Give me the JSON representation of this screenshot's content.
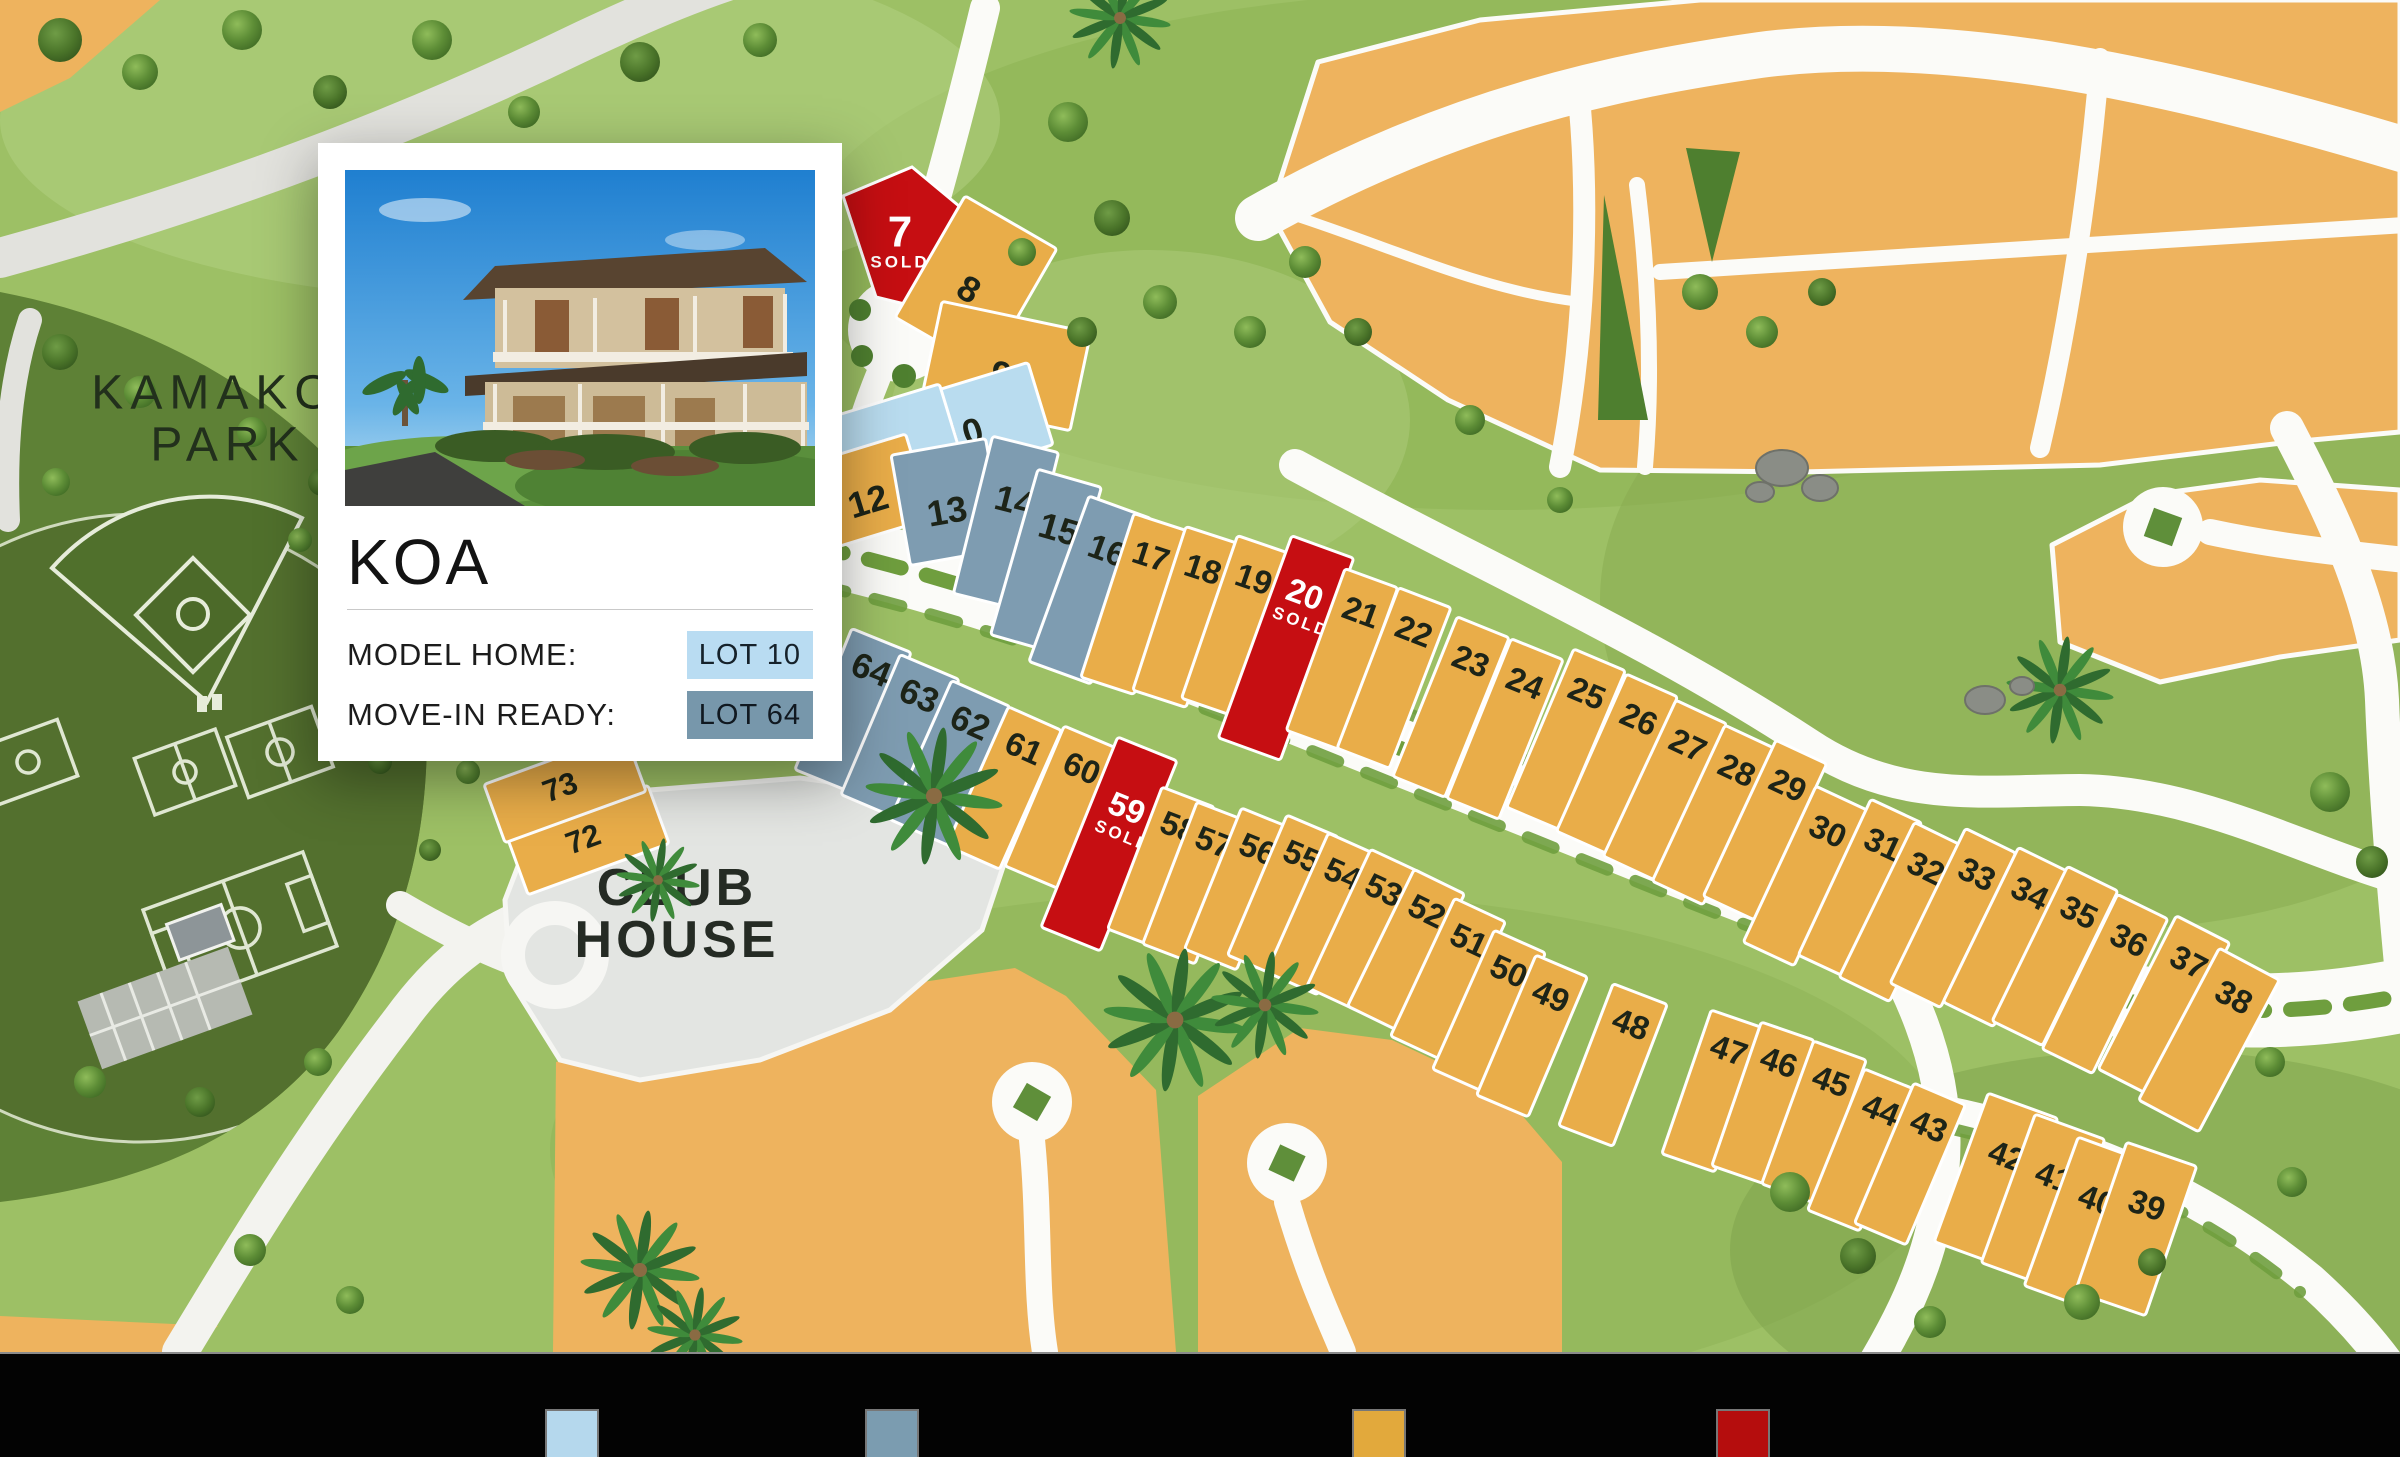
{
  "card": {
    "community_name": "KOA",
    "model_home_label": "MODEL HOME:",
    "model_home_value": "LOT 10",
    "move_in_label": "MOVE-IN READY:",
    "move_in_value": "LOT 64"
  },
  "map": {
    "park_name_line1": "KAMAKO",
    "park_name_line2": "PARK",
    "club_house_line1": "CLUB",
    "club_house_line2": "HOUSE",
    "sold_text": "SOLD",
    "status_colors": {
      "av": "#e9ad49",
      "mh": "#b9dcef",
      "mr": "#7e9cb1",
      "sd": "#c60e12"
    },
    "lot_number_color": "#1d2418",
    "lots": [
      {
        "n": "7",
        "s": "sd",
        "pts": "843,196 912,167 965,211 921,308 876,297",
        "lx": 900,
        "ly": 232,
        "sx": 900,
        "sy": 262,
        "fs": 44
      },
      {
        "n": "8",
        "s": "av",
        "cx": 976,
        "cy": 283,
        "a": 30,
        "w": 106,
        "h": 140,
        "lx": 969,
        "ly": 289,
        "fs": 36
      },
      {
        "n": "9",
        "s": "av",
        "cx": 1006,
        "cy": 366,
        "a": 12,
        "w": 152,
        "h": 100,
        "lx": 1001,
        "ly": 374,
        "fs": 36
      },
      {
        "n": "10",
        "s": "mh",
        "cx": 964,
        "cy": 427,
        "a": -17,
        "w": 160,
        "h": 86,
        "lx": 963,
        "ly": 434,
        "fs": 36
      },
      {
        "n": "11",
        "s": "mh",
        "cx": 893,
        "cy": 441,
        "a": -17,
        "w": 122,
        "h": 82,
        "lx": 894,
        "ly": 449,
        "fs": 36
      },
      {
        "n": "12",
        "s": "av",
        "cx": 863,
        "cy": 493,
        "a": -17,
        "w": 116,
        "h": 88,
        "lx": 868,
        "ly": 501,
        "fs": 36
      },
      {
        "n": "13",
        "s": "mr",
        "cx": 948,
        "cy": 502,
        "a": -10,
        "w": 96,
        "h": 112,
        "lx": 947,
        "ly": 511,
        "fs": 36
      },
      {
        "n": "14",
        "s": "mr",
        "cx": 1006,
        "cy": 523,
        "a": 14,
        "w": 68,
        "h": 162,
        "lx": 1015,
        "ly": 501,
        "fs": 36
      },
      {
        "n": "15",
        "s": "mr",
        "cx": 1046,
        "cy": 561,
        "a": 16,
        "w": 66,
        "h": 172,
        "lx": 1059,
        "ly": 529,
        "fs": 36
      },
      {
        "n": "16",
        "s": "mr",
        "cx": 1090,
        "cy": 590,
        "a": 20,
        "w": 66,
        "h": 176,
        "lx": 1107,
        "ly": 551,
        "fs": 34
      },
      {
        "n": "17",
        "s": "av",
        "cx": 1134,
        "cy": 604,
        "a": 18,
        "w": 56,
        "h": 172,
        "lx": 1151,
        "ly": 556
      },
      {
        "n": "18",
        "s": "av",
        "cx": 1186,
        "cy": 617,
        "a": 18,
        "w": 56,
        "h": 172,
        "lx": 1203,
        "ly": 569
      },
      {
        "n": "19",
        "s": "av",
        "cx": 1236,
        "cy": 626,
        "a": 19,
        "w": 56,
        "h": 172,
        "lx": 1254,
        "ly": 579
      },
      {
        "n": "20",
        "s": "sd",
        "cx": 1286,
        "cy": 648,
        "a": 20,
        "w": 66,
        "h": 215,
        "lx": 1305,
        "ly": 594,
        "sx": 1301,
        "sy": 622
      },
      {
        "n": "21",
        "s": "av",
        "cx": 1342,
        "cy": 659,
        "a": 20,
        "w": 56,
        "h": 172,
        "lx": 1361,
        "ly": 612
      },
      {
        "n": "22",
        "s": "av",
        "cx": 1394,
        "cy": 678,
        "a": 21,
        "w": 56,
        "h": 172,
        "lx": 1414,
        "ly": 631
      },
      {
        "n": "23",
        "s": "av",
        "cx": 1451,
        "cy": 707,
        "a": 22,
        "w": 56,
        "h": 172,
        "lx": 1471,
        "ly": 661
      },
      {
        "n": "24",
        "s": "av",
        "cx": 1505,
        "cy": 729,
        "a": 22,
        "w": 56,
        "h": 172,
        "lx": 1525,
        "ly": 683
      },
      {
        "n": "25",
        "s": "av",
        "cx": 1566,
        "cy": 739,
        "a": 23,
        "w": 56,
        "h": 172,
        "lx": 1587,
        "ly": 693
      },
      {
        "n": "26",
        "s": "av",
        "cx": 1617,
        "cy": 764,
        "a": 24,
        "w": 56,
        "h": 172,
        "lx": 1639,
        "ly": 719
      },
      {
        "n": "27",
        "s": "av",
        "cx": 1665,
        "cy": 790,
        "a": 25,
        "w": 56,
        "h": 172,
        "lx": 1688,
        "ly": 745
      },
      {
        "n": "28",
        "s": "av",
        "cx": 1714,
        "cy": 815,
        "a": 25,
        "w": 56,
        "h": 172,
        "lx": 1737,
        "ly": 770
      },
      {
        "n": "29",
        "s": "av",
        "cx": 1765,
        "cy": 830,
        "a": 25,
        "w": 56,
        "h": 172,
        "lx": 1788,
        "ly": 785
      },
      {
        "n": "30",
        "s": "av",
        "cx": 1805,
        "cy": 876,
        "a": 25,
        "w": 56,
        "h": 172,
        "lx": 1828,
        "ly": 831
      },
      {
        "n": "31",
        "s": "av",
        "cx": 1860,
        "cy": 889,
        "a": 25,
        "w": 56,
        "h": 172,
        "lx": 1883,
        "ly": 844
      },
      {
        "n": "32",
        "s": "av",
        "cx": 1902,
        "cy": 912,
        "a": 26,
        "w": 56,
        "h": 172,
        "lx": 1926,
        "ly": 868
      },
      {
        "n": "33",
        "s": "av",
        "cx": 1953,
        "cy": 918,
        "a": 26,
        "w": 56,
        "h": 172,
        "lx": 1977,
        "ly": 874
      },
      {
        "n": "34",
        "s": "av",
        "cx": 2006,
        "cy": 937,
        "a": 26,
        "w": 56,
        "h": 172,
        "lx": 2030,
        "ly": 893
      },
      {
        "n": "35",
        "s": "av",
        "cx": 2055,
        "cy": 956,
        "a": 26,
        "w": 56,
        "h": 172,
        "lx": 2079,
        "ly": 912
      },
      {
        "n": "36",
        "s": "av",
        "cx": 2105,
        "cy": 984,
        "a": 26,
        "w": 56,
        "h": 172,
        "lx": 2129,
        "ly": 940
      },
      {
        "n": "37",
        "s": "av",
        "cx": 2164,
        "cy": 1006,
        "a": 27,
        "w": 60,
        "h": 172,
        "lx": 2189,
        "ly": 962
      },
      {
        "n": "38",
        "s": "av",
        "cx": 2209,
        "cy": 1040,
        "a": 28,
        "w": 68,
        "h": 172,
        "lx": 2234,
        "ly": 997
      },
      {
        "n": "64",
        "s": "mr",
        "cx": 853,
        "cy": 711,
        "a": 22,
        "w": 64,
        "h": 152,
        "lx": 871,
        "ly": 670,
        "fs": 35
      },
      {
        "n": "63",
        "s": "mr",
        "cx": 900,
        "cy": 737,
        "a": 23,
        "w": 64,
        "h": 152,
        "lx": 919,
        "ly": 696,
        "fs": 35
      },
      {
        "n": "62",
        "s": "mr",
        "cx": 950,
        "cy": 763,
        "a": 24,
        "w": 64,
        "h": 152,
        "lx": 970,
        "ly": 723,
        "fs": 35
      },
      {
        "n": "61",
        "s": "av",
        "cx": 1004,
        "cy": 788,
        "a": 24,
        "w": 58,
        "h": 152,
        "lx": 1024,
        "ly": 748
      },
      {
        "n": "60",
        "s": "av",
        "cx": 1063,
        "cy": 808,
        "a": 23,
        "w": 62,
        "h": 152,
        "lx": 1082,
        "ly": 768
      },
      {
        "n": "59",
        "s": "sd",
        "cx": 1109,
        "cy": 844,
        "a": 22,
        "w": 64,
        "h": 205,
        "lx": 1127,
        "ly": 808,
        "sx": 1123,
        "sy": 836
      },
      {
        "n": "58",
        "s": "av",
        "cx": 1161,
        "cy": 868,
        "a": 21,
        "w": 56,
        "h": 152,
        "lx": 1179,
        "ly": 827
      },
      {
        "n": "57",
        "s": "av",
        "cx": 1196,
        "cy": 883,
        "a": 21,
        "w": 56,
        "h": 152,
        "lx": 1214,
        "ly": 842
      },
      {
        "n": "56",
        "s": "av",
        "cx": 1239,
        "cy": 889,
        "a": 22,
        "w": 56,
        "h": 152,
        "lx": 1258,
        "ly": 849
      },
      {
        "n": "55",
        "s": "av",
        "cx": 1283,
        "cy": 896,
        "a": 23,
        "w": 56,
        "h": 152,
        "lx": 1302,
        "ly": 856
      },
      {
        "n": "54",
        "s": "av",
        "cx": 1323,
        "cy": 914,
        "a": 24,
        "w": 56,
        "h": 152,
        "lx": 1343,
        "ly": 874
      },
      {
        "n": "53",
        "s": "av",
        "cx": 1364,
        "cy": 930,
        "a": 25,
        "w": 56,
        "h": 152,
        "lx": 1384,
        "ly": 890
      },
      {
        "n": "52",
        "s": "av",
        "cx": 1406,
        "cy": 950,
        "a": 26,
        "w": 56,
        "h": 152,
        "lx": 1427,
        "ly": 911
      },
      {
        "n": "51",
        "s": "av",
        "cx": 1448,
        "cy": 979,
        "a": 25,
        "w": 56,
        "h": 152,
        "lx": 1469,
        "ly": 940
      },
      {
        "n": "50",
        "s": "av",
        "cx": 1489,
        "cy": 1011,
        "a": 24,
        "w": 56,
        "h": 152,
        "lx": 1509,
        "ly": 971
      },
      {
        "n": "49",
        "s": "av",
        "cx": 1532,
        "cy": 1036,
        "a": 23,
        "w": 56,
        "h": 152,
        "lx": 1551,
        "ly": 996
      },
      {
        "n": "48",
        "s": "av",
        "cx": 1613,
        "cy": 1065,
        "a": 21,
        "w": 58,
        "h": 152,
        "lx": 1631,
        "ly": 1024
      },
      {
        "n": "47",
        "s": "av",
        "cx": 1713,
        "cy": 1091,
        "a": 19,
        "w": 56,
        "h": 152,
        "lx": 1729,
        "ly": 1050
      },
      {
        "n": "46",
        "s": "av",
        "cx": 1763,
        "cy": 1103,
        "a": 19,
        "w": 56,
        "h": 152,
        "lx": 1779,
        "ly": 1062
      },
      {
        "n": "45",
        "s": "av",
        "cx": 1814,
        "cy": 1122,
        "a": 20,
        "w": 56,
        "h": 152,
        "lx": 1831,
        "ly": 1081
      },
      {
        "n": "44",
        "s": "av",
        "cx": 1862,
        "cy": 1150,
        "a": 22,
        "w": 56,
        "h": 152,
        "lx": 1881,
        "ly": 1110
      },
      {
        "n": "43",
        "s": "av",
        "cx": 1910,
        "cy": 1164,
        "a": 23,
        "w": 56,
        "h": 152,
        "lx": 1929,
        "ly": 1126
      },
      {
        "n": "42",
        "s": "av",
        "cx": 1996,
        "cy": 1180,
        "a": 20,
        "w": 74,
        "h": 158,
        "lx": 2007,
        "ly": 1156
      },
      {
        "n": "41",
        "s": "av",
        "cx": 2043,
        "cy": 1201,
        "a": 20,
        "w": 74,
        "h": 158,
        "lx": 2054,
        "ly": 1177
      },
      {
        "n": "40",
        "s": "av",
        "cx": 2086,
        "cy": 1224,
        "a": 20,
        "w": 74,
        "h": 158,
        "lx": 2097,
        "ly": 1200
      },
      {
        "n": "39",
        "s": "av",
        "cx": 2136,
        "cy": 1229,
        "a": 19,
        "w": 74,
        "h": 158,
        "lx": 2147,
        "ly": 1205
      },
      {
        "n": "72",
        "s": "av",
        "cx": 588,
        "cy": 840,
        "a": -20,
        "w": 150,
        "h": 62,
        "lx": 583,
        "ly": 839,
        "fs": 31
      },
      {
        "n": "73",
        "s": "av",
        "cx": 565,
        "cy": 788,
        "a": -20,
        "w": 150,
        "h": 62,
        "lx": 560,
        "ly": 787,
        "fs": 31
      }
    ]
  },
  "legend": {
    "swatches": [
      {
        "name": "model-home",
        "color": "#b5d8ed",
        "x": 545
      },
      {
        "name": "move-in-ready",
        "color": "#7b9cb0",
        "x": 865
      },
      {
        "name": "available",
        "color": "#e2a93c",
        "x": 1352
      },
      {
        "name": "sold",
        "color": "#b50d0d",
        "x": 1716
      }
    ]
  }
}
